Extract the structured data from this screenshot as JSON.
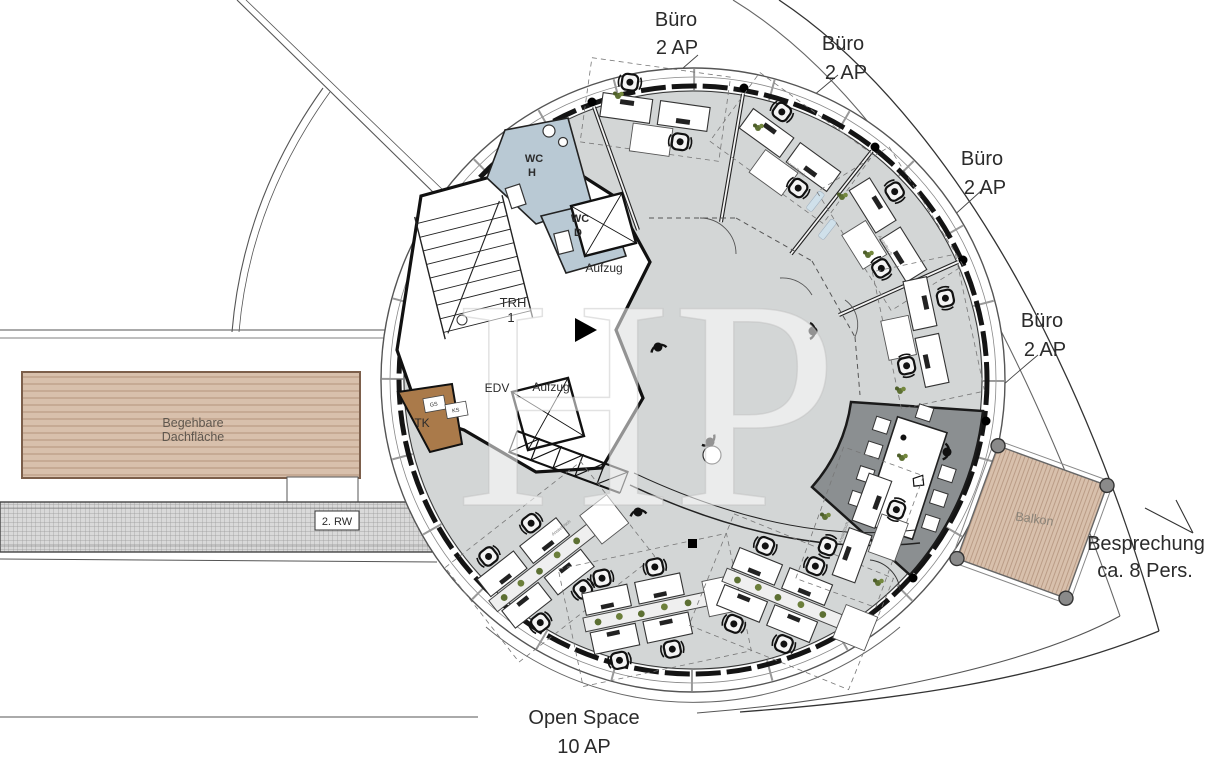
{
  "plan": {
    "watermark": "HP",
    "offices": [
      {
        "name": "Büro",
        "capacity": "2 AP"
      },
      {
        "name": "Büro",
        "capacity": "2 AP"
      },
      {
        "name": "Büro",
        "capacity": "2 AP"
      },
      {
        "name": "Büro",
        "capacity": "2 AP"
      }
    ],
    "meeting_room": {
      "line1": "Besprechung",
      "line2": "ca. 8 Pers."
    },
    "open_space": {
      "line1": "Open Space",
      "line2": "10 AP"
    },
    "roof_terrace": {
      "line1": "Begehbare",
      "line2": "Dachfläche"
    },
    "escape_route": "2. RW",
    "wc_men": {
      "line1": "WC",
      "line2": "H"
    },
    "wc_women": {
      "line1": "WC",
      "line2": "D"
    },
    "elevator1": "Aufzug",
    "elevator2": "Aufzug",
    "stairwell": {
      "line1": "TRH",
      "line2": "1"
    },
    "it_room": "EDV",
    "tk_room": "TK",
    "gs": "GS",
    "ks": "KS",
    "balcony": "Balkon",
    "desk_label": "Anstelltisch"
  },
  "colors": {
    "floor_gray": "#d3d6d6",
    "meeting_dark": "#8b8f91",
    "wc_blue": "#b9c9d4",
    "deck_tan": "#d8c0ac",
    "deck_line": "#b3937c",
    "tk_brown": "#aa7a4a",
    "plant_green": "#5d7033",
    "grating_gray": "#d9d9d9"
  }
}
